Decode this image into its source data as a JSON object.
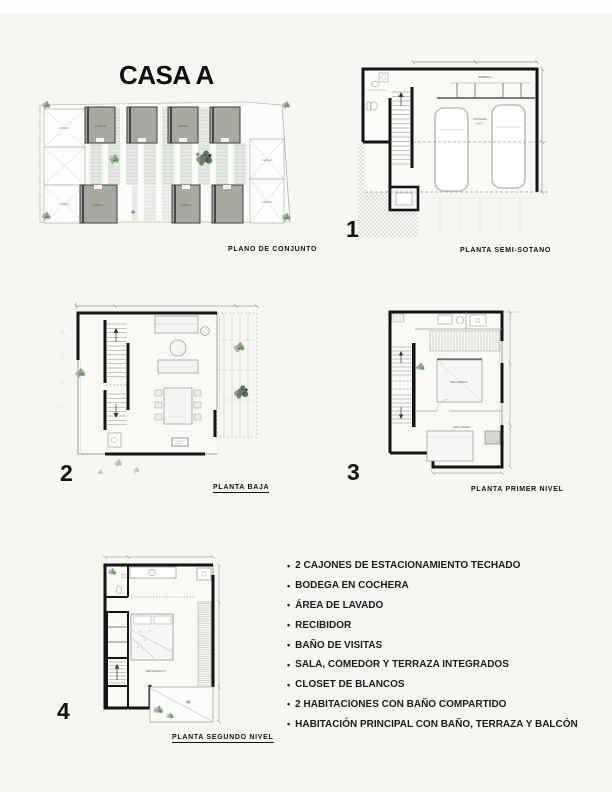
{
  "page": {
    "title": "CASA A"
  },
  "colors": {
    "ink": "#141414",
    "paper": "#f7f6f3",
    "unit_gray": "#a8a8a0",
    "foliage": "#7fa37f"
  },
  "site_plan": {
    "caption": "PLANO DE CONJUNTO",
    "unit_label": "CASA A"
  },
  "plans": [
    {
      "number": "1",
      "caption": "PLANTA SEMI-SOTANO"
    },
    {
      "number": "2",
      "caption": "PLANTA BAJA"
    },
    {
      "number": "3",
      "caption": "PLANTA PRIMER NIVEL"
    },
    {
      "number": "4",
      "caption": "PLANTA SEGUNDO NIVEL"
    }
  ],
  "plan_labels": {
    "bodega": "BODEGA",
    "cochera": "COCHERA",
    "npt": "N.P.T.",
    "recamara": "RECAMARA",
    "recamara_p": "RECAMARA P."
  },
  "features": {
    "items": [
      "2 CAJONES DE ESTACIONAMIENTO TECHADO",
      "BODEGA EN COCHERA",
      "ÁREA DE LAVADO",
      "RECIBIDOR",
      "BAÑO DE VISITAS",
      "SALA, COMEDOR Y TERRAZA INTEGRADOS",
      "CLOSET DE BLANCOS",
      "2 HABITACIONES CON BAÑO COMPARTIDO",
      "HABITACIÓN PRINCIPAL CON BAÑO, TERRAZA Y BALCÓN"
    ]
  }
}
